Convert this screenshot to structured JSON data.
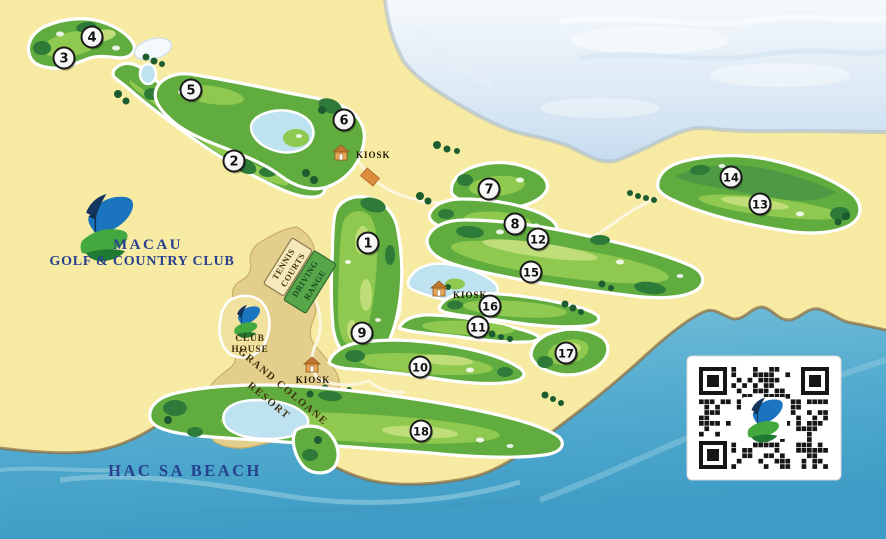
{
  "map": {
    "logo": {
      "title": "MACAU",
      "subtitle": "GOLF & COUNTRY CLUB"
    },
    "beach_label": "HAC SA BEACH",
    "club_house": {
      "line1": "CLUB",
      "line2": "HOUSE"
    },
    "tennis_courts": {
      "line1": "TENNIS",
      "line2": "COURTS"
    },
    "driving_range": {
      "line1": "DRIVING",
      "line2": "RANGE"
    },
    "resort": {
      "line1": "GRAND COLOANE",
      "line2": "RESORT"
    },
    "kiosk_label": "KIOSK",
    "holes": [
      {
        "number": 1,
        "x": 368,
        "y": 243
      },
      {
        "number": 2,
        "x": 234,
        "y": 161
      },
      {
        "number": 3,
        "x": 64,
        "y": 58
      },
      {
        "number": 4,
        "x": 92,
        "y": 37
      },
      {
        "number": 5,
        "x": 191,
        "y": 90
      },
      {
        "number": 6,
        "x": 344,
        "y": 120
      },
      {
        "number": 7,
        "x": 489,
        "y": 189
      },
      {
        "number": 8,
        "x": 515,
        "y": 224
      },
      {
        "number": 9,
        "x": 362,
        "y": 333
      },
      {
        "number": 10,
        "x": 420,
        "y": 367
      },
      {
        "number": 11,
        "x": 478,
        "y": 327
      },
      {
        "number": 12,
        "x": 538,
        "y": 239
      },
      {
        "number": 13,
        "x": 760,
        "y": 204
      },
      {
        "number": 14,
        "x": 731,
        "y": 177
      },
      {
        "number": 15,
        "x": 531,
        "y": 272
      },
      {
        "number": 16,
        "x": 490,
        "y": 306
      },
      {
        "number": 17,
        "x": 566,
        "y": 353
      },
      {
        "number": 18,
        "x": 421,
        "y": 431
      }
    ],
    "kiosks": [
      {
        "x": 341,
        "y": 159,
        "label_x": 356,
        "label_y": 158,
        "anchor": "start"
      },
      {
        "x": 439,
        "y": 295,
        "label_x": 453,
        "label_y": 298,
        "anchor": "start"
      },
      {
        "x": 312,
        "y": 371,
        "label_x": 313,
        "label_y": 383,
        "anchor": "middle"
      }
    ],
    "colors": {
      "land": "#F7EAA3",
      "resort": "#E3CF8B",
      "sea_deep": "#3D9BC5",
      "sea_light": "#7CC2D9",
      "water_top": "#C6DCEF",
      "fairway": "#61AC3E",
      "fairway_light": "#8FC94F",
      "stripe": "#BFDD78",
      "rough_dark": "#2E7A39",
      "tree": "#1D5C2E",
      "lake": "#BEE2F0",
      "logo_blue": "#1B74BE",
      "logo_green": "#2E9140",
      "text_navy": "#27418E",
      "text_brown": "#43320F",
      "marker_ring": "#1A1A1A",
      "kiosk_body": "#E8A353",
      "kiosk_roof": "#C0762F",
      "bridge": "#DE8C3E",
      "qr_dark": "#161616"
    }
  }
}
